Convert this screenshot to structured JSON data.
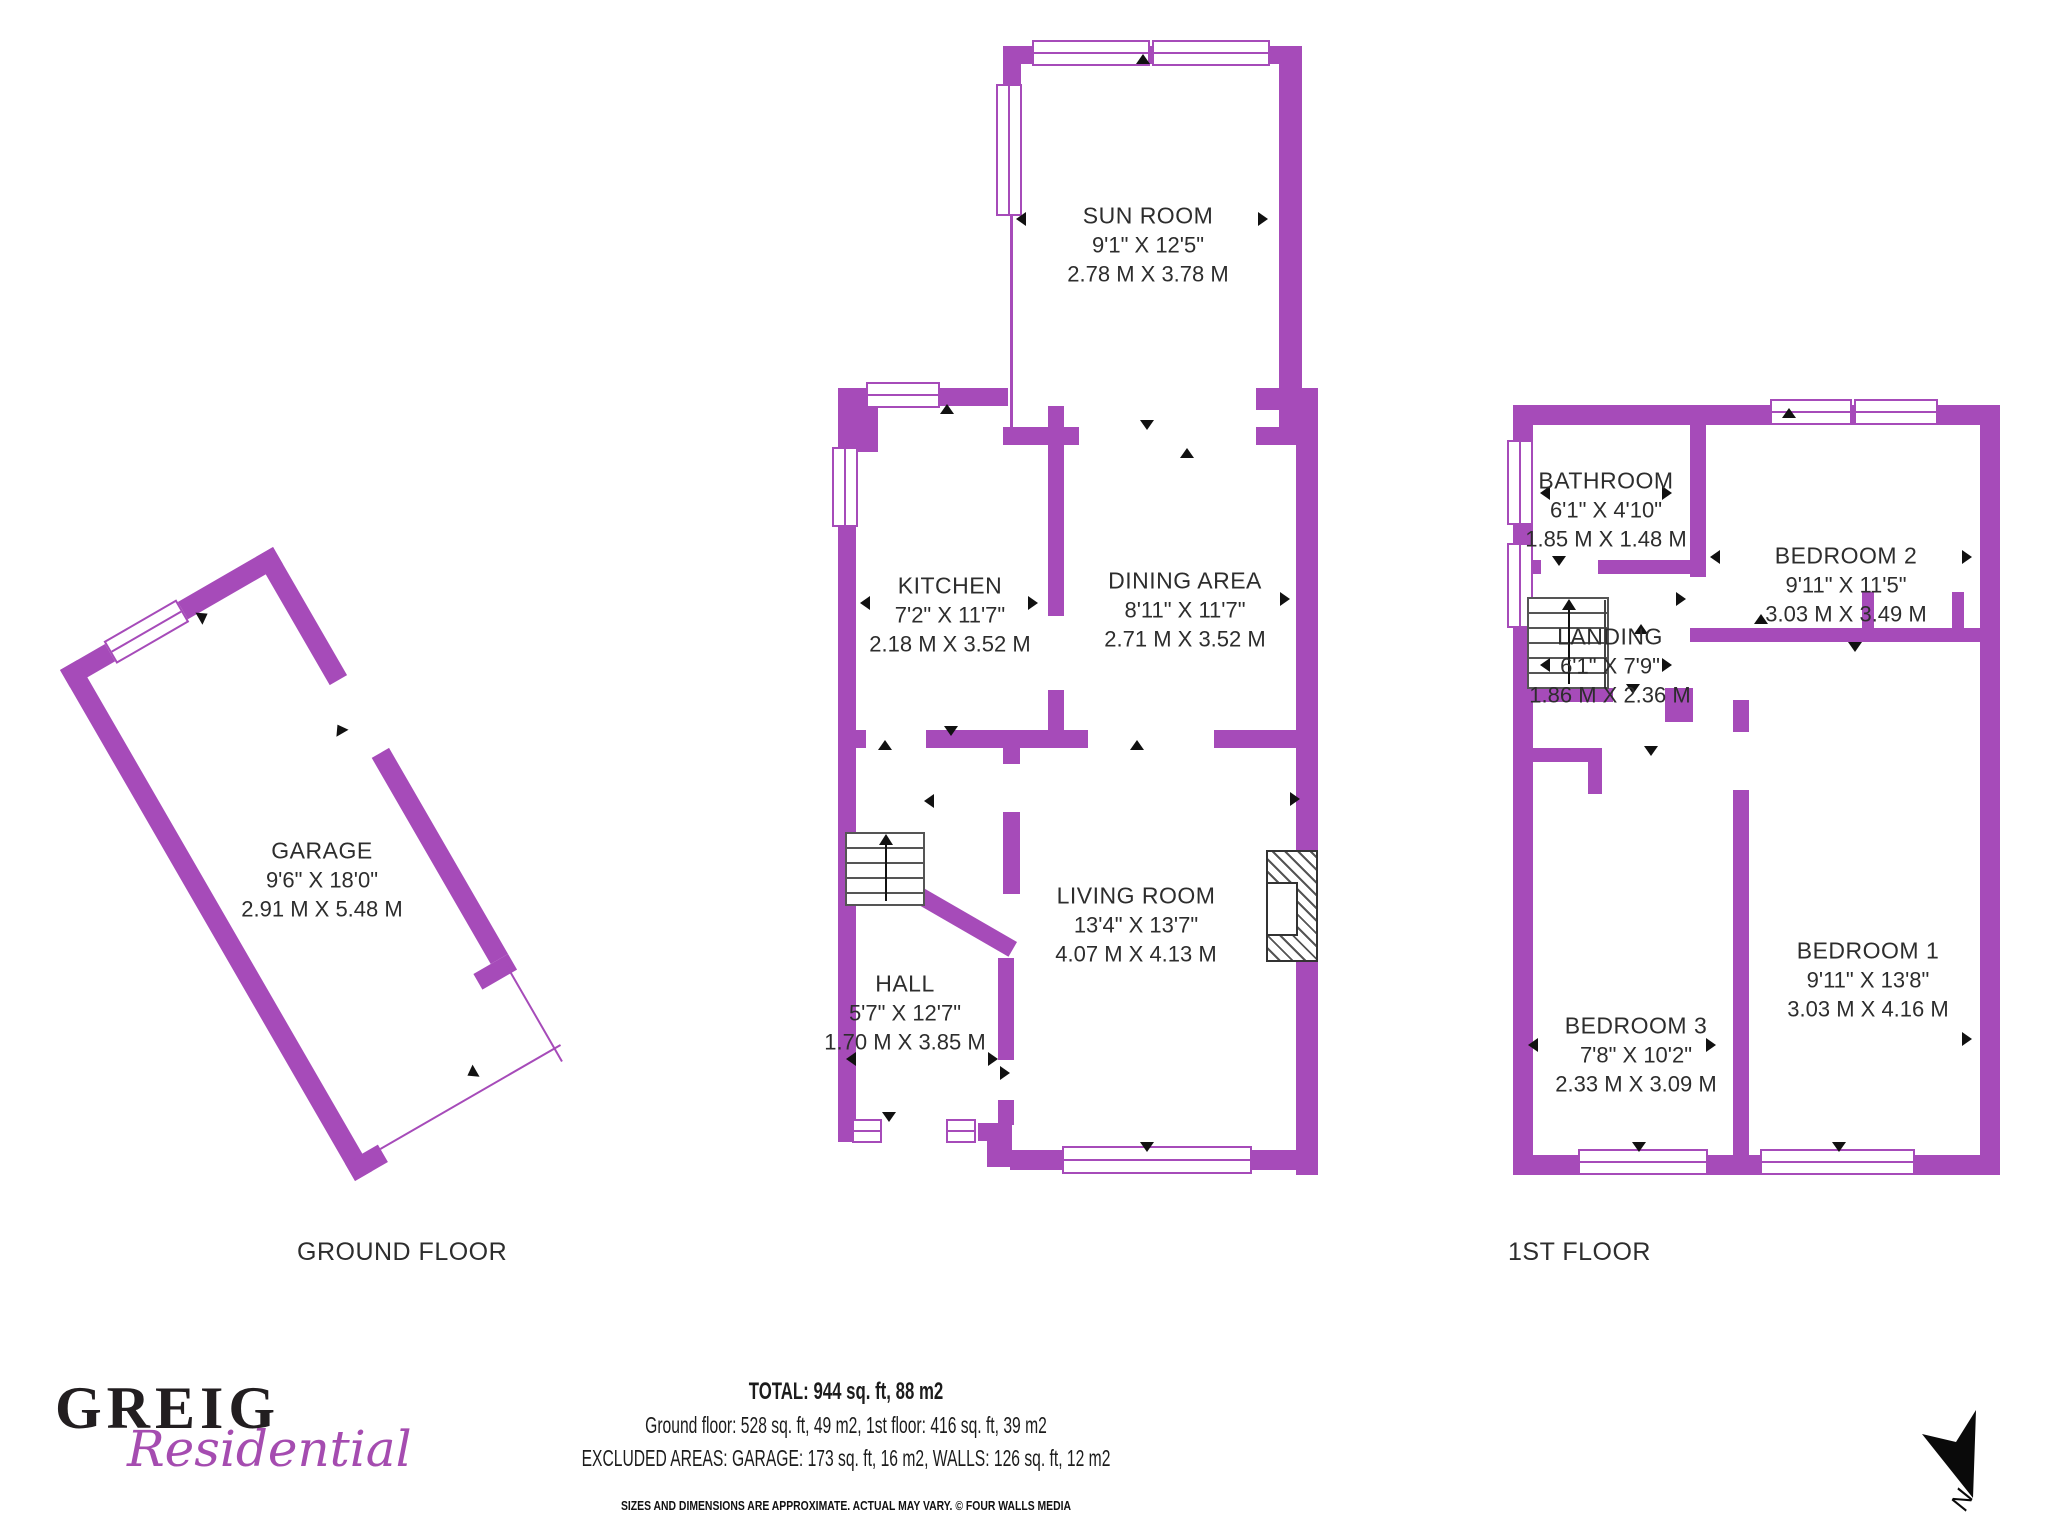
{
  "colors": {
    "wall": "#A64BB9",
    "logo_purple": "#A54CB0",
    "text": "#2d2d2d"
  },
  "ground_floor": {
    "title": "GROUND FLOOR",
    "rooms": {
      "sun_room": {
        "name": "SUN ROOM",
        "imperial": "9'1\" X 12'5\"",
        "metric": "2.78 M X 3.78 M"
      },
      "kitchen": {
        "name": "KITCHEN",
        "imperial": "7'2\" X 11'7\"",
        "metric": "2.18 M X 3.52 M"
      },
      "dining": {
        "name": "DINING AREA",
        "imperial": "8'11\" X 11'7\"",
        "metric": "2.71 M X 3.52 M"
      },
      "living": {
        "name": "LIVING ROOM",
        "imperial": "13'4\" X 13'7\"",
        "metric": "4.07 M X 4.13 M"
      },
      "hall": {
        "name": "HALL",
        "imperial": "5'7\" X 12'7\"",
        "metric": "1.70 M X 3.85 M"
      },
      "garage": {
        "name": "GARAGE",
        "imperial": "9'6\" X 18'0\"",
        "metric": "2.91 M X 5.48 M"
      }
    }
  },
  "first_floor": {
    "title": "1ST FLOOR",
    "rooms": {
      "bathroom": {
        "name": "BATHROOM",
        "imperial": "6'1\" X 4'10\"",
        "metric": "1.85 M X 1.48 M"
      },
      "landing": {
        "name": "LANDING",
        "imperial": "6'1\" X 7'9\"",
        "metric": "1.86 M X 2.36 M"
      },
      "bedroom2": {
        "name": "BEDROOM 2",
        "imperial": "9'11\" X 11'5\"",
        "metric": "3.03 M X 3.49 M"
      },
      "bedroom1": {
        "name": "BEDROOM 1",
        "imperial": "9'11\" X 13'8\"",
        "metric": "3.03 M X 4.16 M"
      },
      "bedroom3": {
        "name": "BEDROOM 3",
        "imperial": "7'8\" X 10'2\"",
        "metric": "2.33 M X 3.09 M"
      }
    }
  },
  "footer": {
    "total": "TOTAL: 944 sq. ft, 88 m2",
    "floors": "Ground floor: 528 sq. ft, 49 m2, 1st floor: 416 sq. ft, 39 m2",
    "excluded": "EXCLUDED AREAS: GARAGE: 173 sq. ft, 16 m2, WALLS: 126 sq. ft, 12 m2",
    "disclaimer": "SIZES AND DIMENSIONS ARE APPROXIMATE. ACTUAL MAY VARY. © FOUR WALLS MEDIA"
  },
  "logo": {
    "name": "GREIG",
    "tagline": "Residential"
  },
  "compass": {
    "label": "N"
  }
}
